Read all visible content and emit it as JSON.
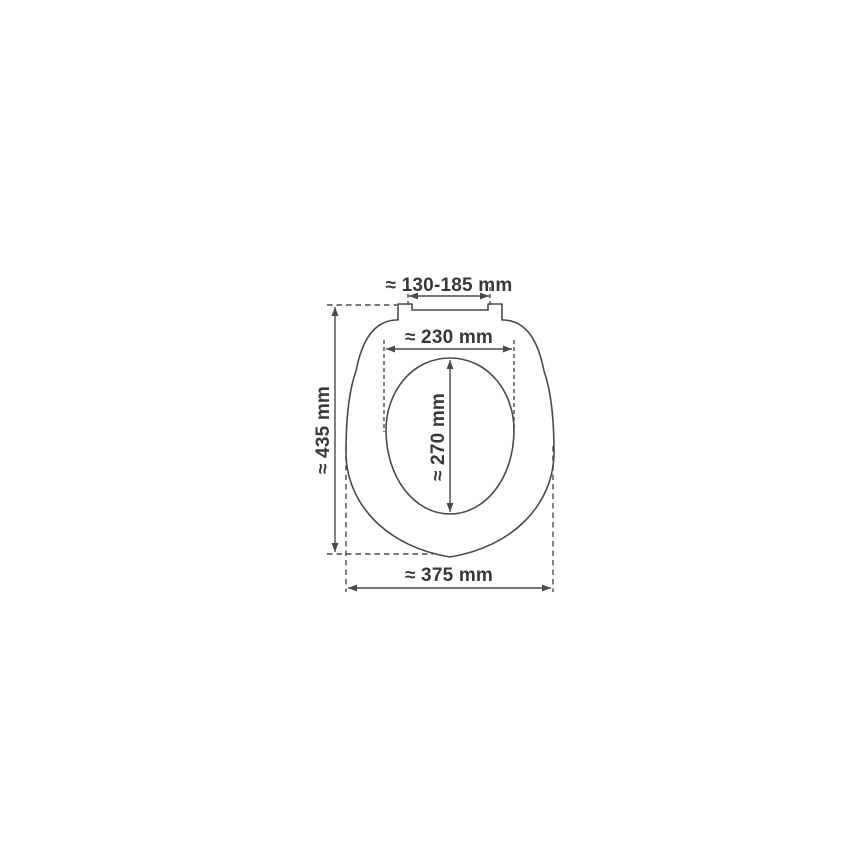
{
  "diagram": {
    "subject": "toilet-seat-top-view-dimension-drawing",
    "background_color": "#ffffff",
    "line_color": "#4a4a4a",
    "text_color": "#383838",
    "dimensions": {
      "hinge_spacing": "≈ 130-185 mm",
      "opening_width": "≈ 230 mm",
      "opening_length": "≈ 270 mm",
      "overall_length": "≈ 435 mm",
      "overall_width": "≈ 375 mm"
    }
  }
}
